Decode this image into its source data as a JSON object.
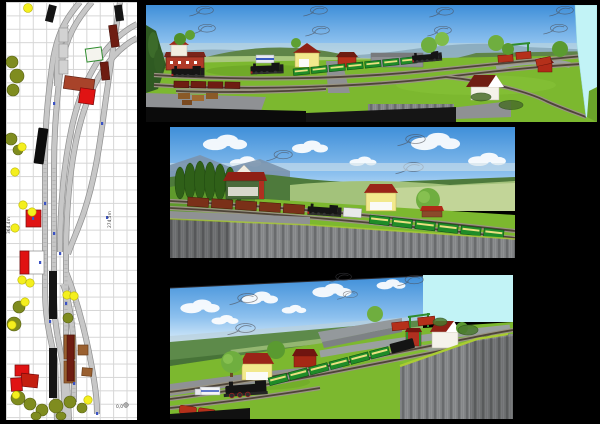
{
  "window": {
    "background": "#000000"
  },
  "plan": {
    "name": "track-plan",
    "labels": {
      "length_left": "364,4m",
      "length_right": "274,5m",
      "datum": "0,0"
    }
  },
  "views": [
    {
      "id": "top",
      "name": "3d-view-overview"
    },
    {
      "id": "middle",
      "name": "3d-view-station"
    },
    {
      "id": "bottom",
      "name": "3d-view-corner"
    }
  ],
  "palette": {
    "page_bg": "#000000",
    "plan_bg": "#ffffff",
    "plan_grid": "#d6d6d6",
    "track_fill": "#c7c7c7",
    "track_edge": "#8f8f8f",
    "building_red": "#e01313",
    "brick_red": "#a8432a",
    "platform_brown": "#9a6030",
    "tree_yellow": "#f4ef1e",
    "tree_olive": "#7f8c1f",
    "train_black": "#151515",
    "car_maroon": "#6e1d12",
    "marker_blue": "#3a52c4",
    "sky_top": "#3f8fd9",
    "sky_mid": "#8cc0ee",
    "sky_bottom": "#ddeffb",
    "grass": "#7cb82f",
    "road": "#8f9194",
    "fascia": "#7e8082",
    "cyan": "#c2f3f6",
    "coach_green": "#1f8c28",
    "boxcar_brown": "#7a3018",
    "wagon_red": "#b5301a",
    "roof_red": "#9a2418",
    "wall_yellow": "#f2e98c",
    "edge_green": "#aacc33"
  }
}
